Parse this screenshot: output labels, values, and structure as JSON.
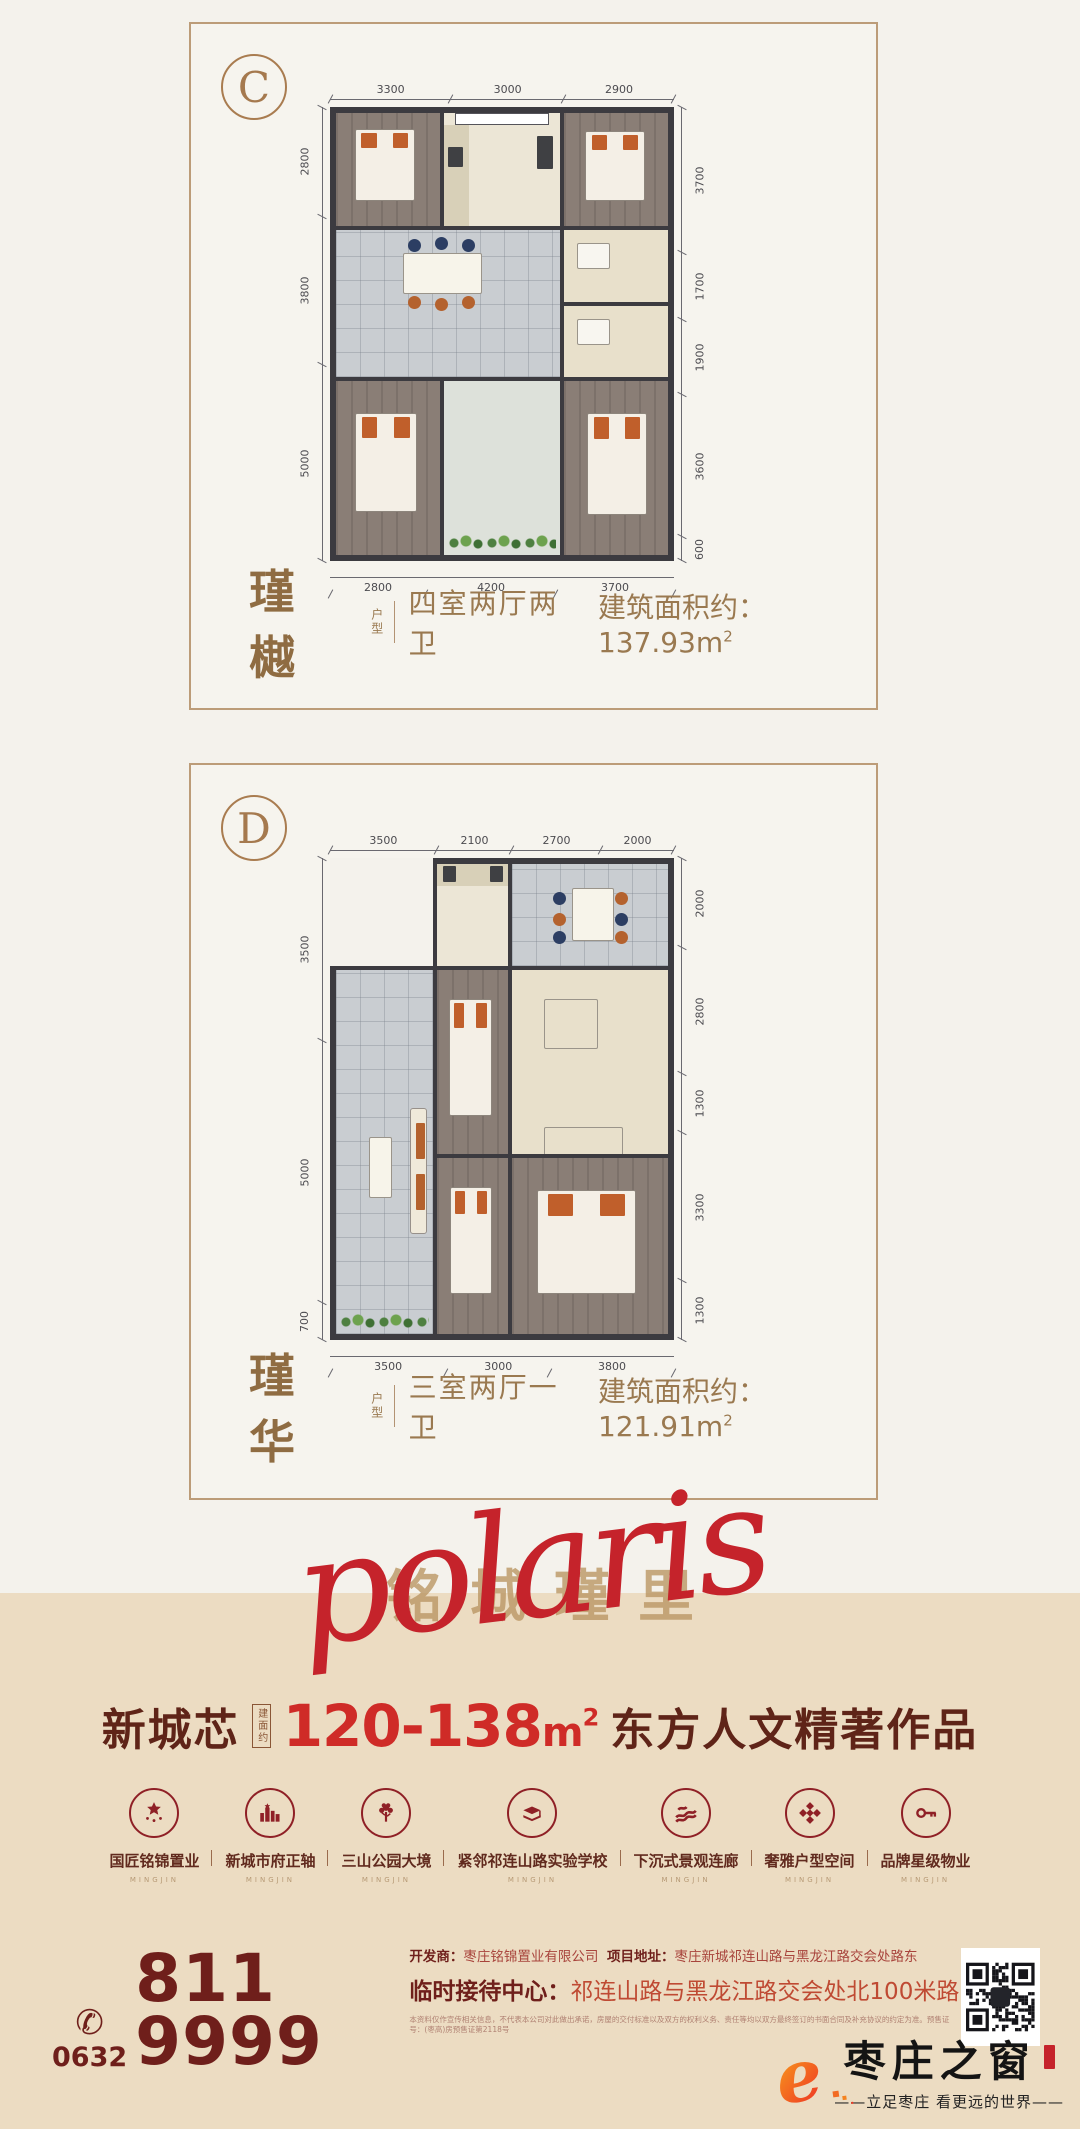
{
  "plans": [
    {
      "tag": "C",
      "name": "瑾 樾",
      "name_suffix": "户型",
      "desc": "四室两厅两卫",
      "area_label": "建筑面积约：",
      "area": "137.93",
      "area_unit": "m",
      "area_sup": "2",
      "dims": {
        "top": [
          "3300",
          "3000",
          "2900"
        ],
        "left": [
          "2800",
          "3800",
          "5000"
        ],
        "right": [
          "3700",
          "1700",
          "1900",
          "3600",
          "600"
        ],
        "bottom": [
          "2800",
          "4200",
          "3700"
        ]
      }
    },
    {
      "tag": "D",
      "name": "瑾 华",
      "name_suffix": "户型",
      "desc": "三室两厅一卫",
      "area_label": "建筑面积约：",
      "area": "121.91",
      "area_unit": "m",
      "area_sup": "2",
      "dims": {
        "top": [
          "3500",
          "2100",
          "2700",
          "2000"
        ],
        "left": [
          "3500",
          "5000",
          "700"
        ],
        "right": [
          "2000",
          "2800",
          "1300",
          "3300",
          "1300"
        ],
        "bottom": [
          "3500",
          "3000",
          "3800"
        ]
      }
    }
  ],
  "script_art": {
    "latin": "polaris",
    "chinese": "铭城瑾里"
  },
  "headline": {
    "prefix": "新城芯",
    "seal": "建面约",
    "range": "120-138",
    "unit": "m",
    "sup": "2",
    "suffix": "东方人文精著作品"
  },
  "features": [
    {
      "label": "国匠铭锦置业",
      "sub": "MINGJIN"
    },
    {
      "label": "新城市府正轴",
      "sub": "MINGJIN"
    },
    {
      "label": "三山公园大境",
      "sub": "MINGJIN"
    },
    {
      "label": "紧邻祁连山路实验学校",
      "sub": "MINGJIN"
    },
    {
      "label": "下沉式景观连廊",
      "sub": "MINGJIN"
    },
    {
      "label": "奢雅户型空间",
      "sub": "MINGJIN"
    },
    {
      "label": "品牌星级物业",
      "sub": "MINGJIN"
    }
  ],
  "contact": {
    "area_code": "0632",
    "phone": "811 9999",
    "dev_label": "开发商：",
    "dev": "枣庄铭锦置业有限公司",
    "addr_label": "项目地址：",
    "addr": "枣庄新城祁连山路与黑龙江路交会处路东",
    "center_label": "临时接待中心：",
    "center": "祁连山路与黑龙江路交会处北100米路东",
    "disclaimer": "本资料仅作宣传相关信息，不代表本公司对此做出承诺，房屋的交付标准以及双方的权利义务、责任等均以双方最终签订的书面合同及补充协议的约定为准。预售证号：(枣高)房预售证第2118号"
  },
  "footer_logo": {
    "name": "枣庄之窗",
    "tagline": "——立足枣庄 看更远的世界——"
  }
}
